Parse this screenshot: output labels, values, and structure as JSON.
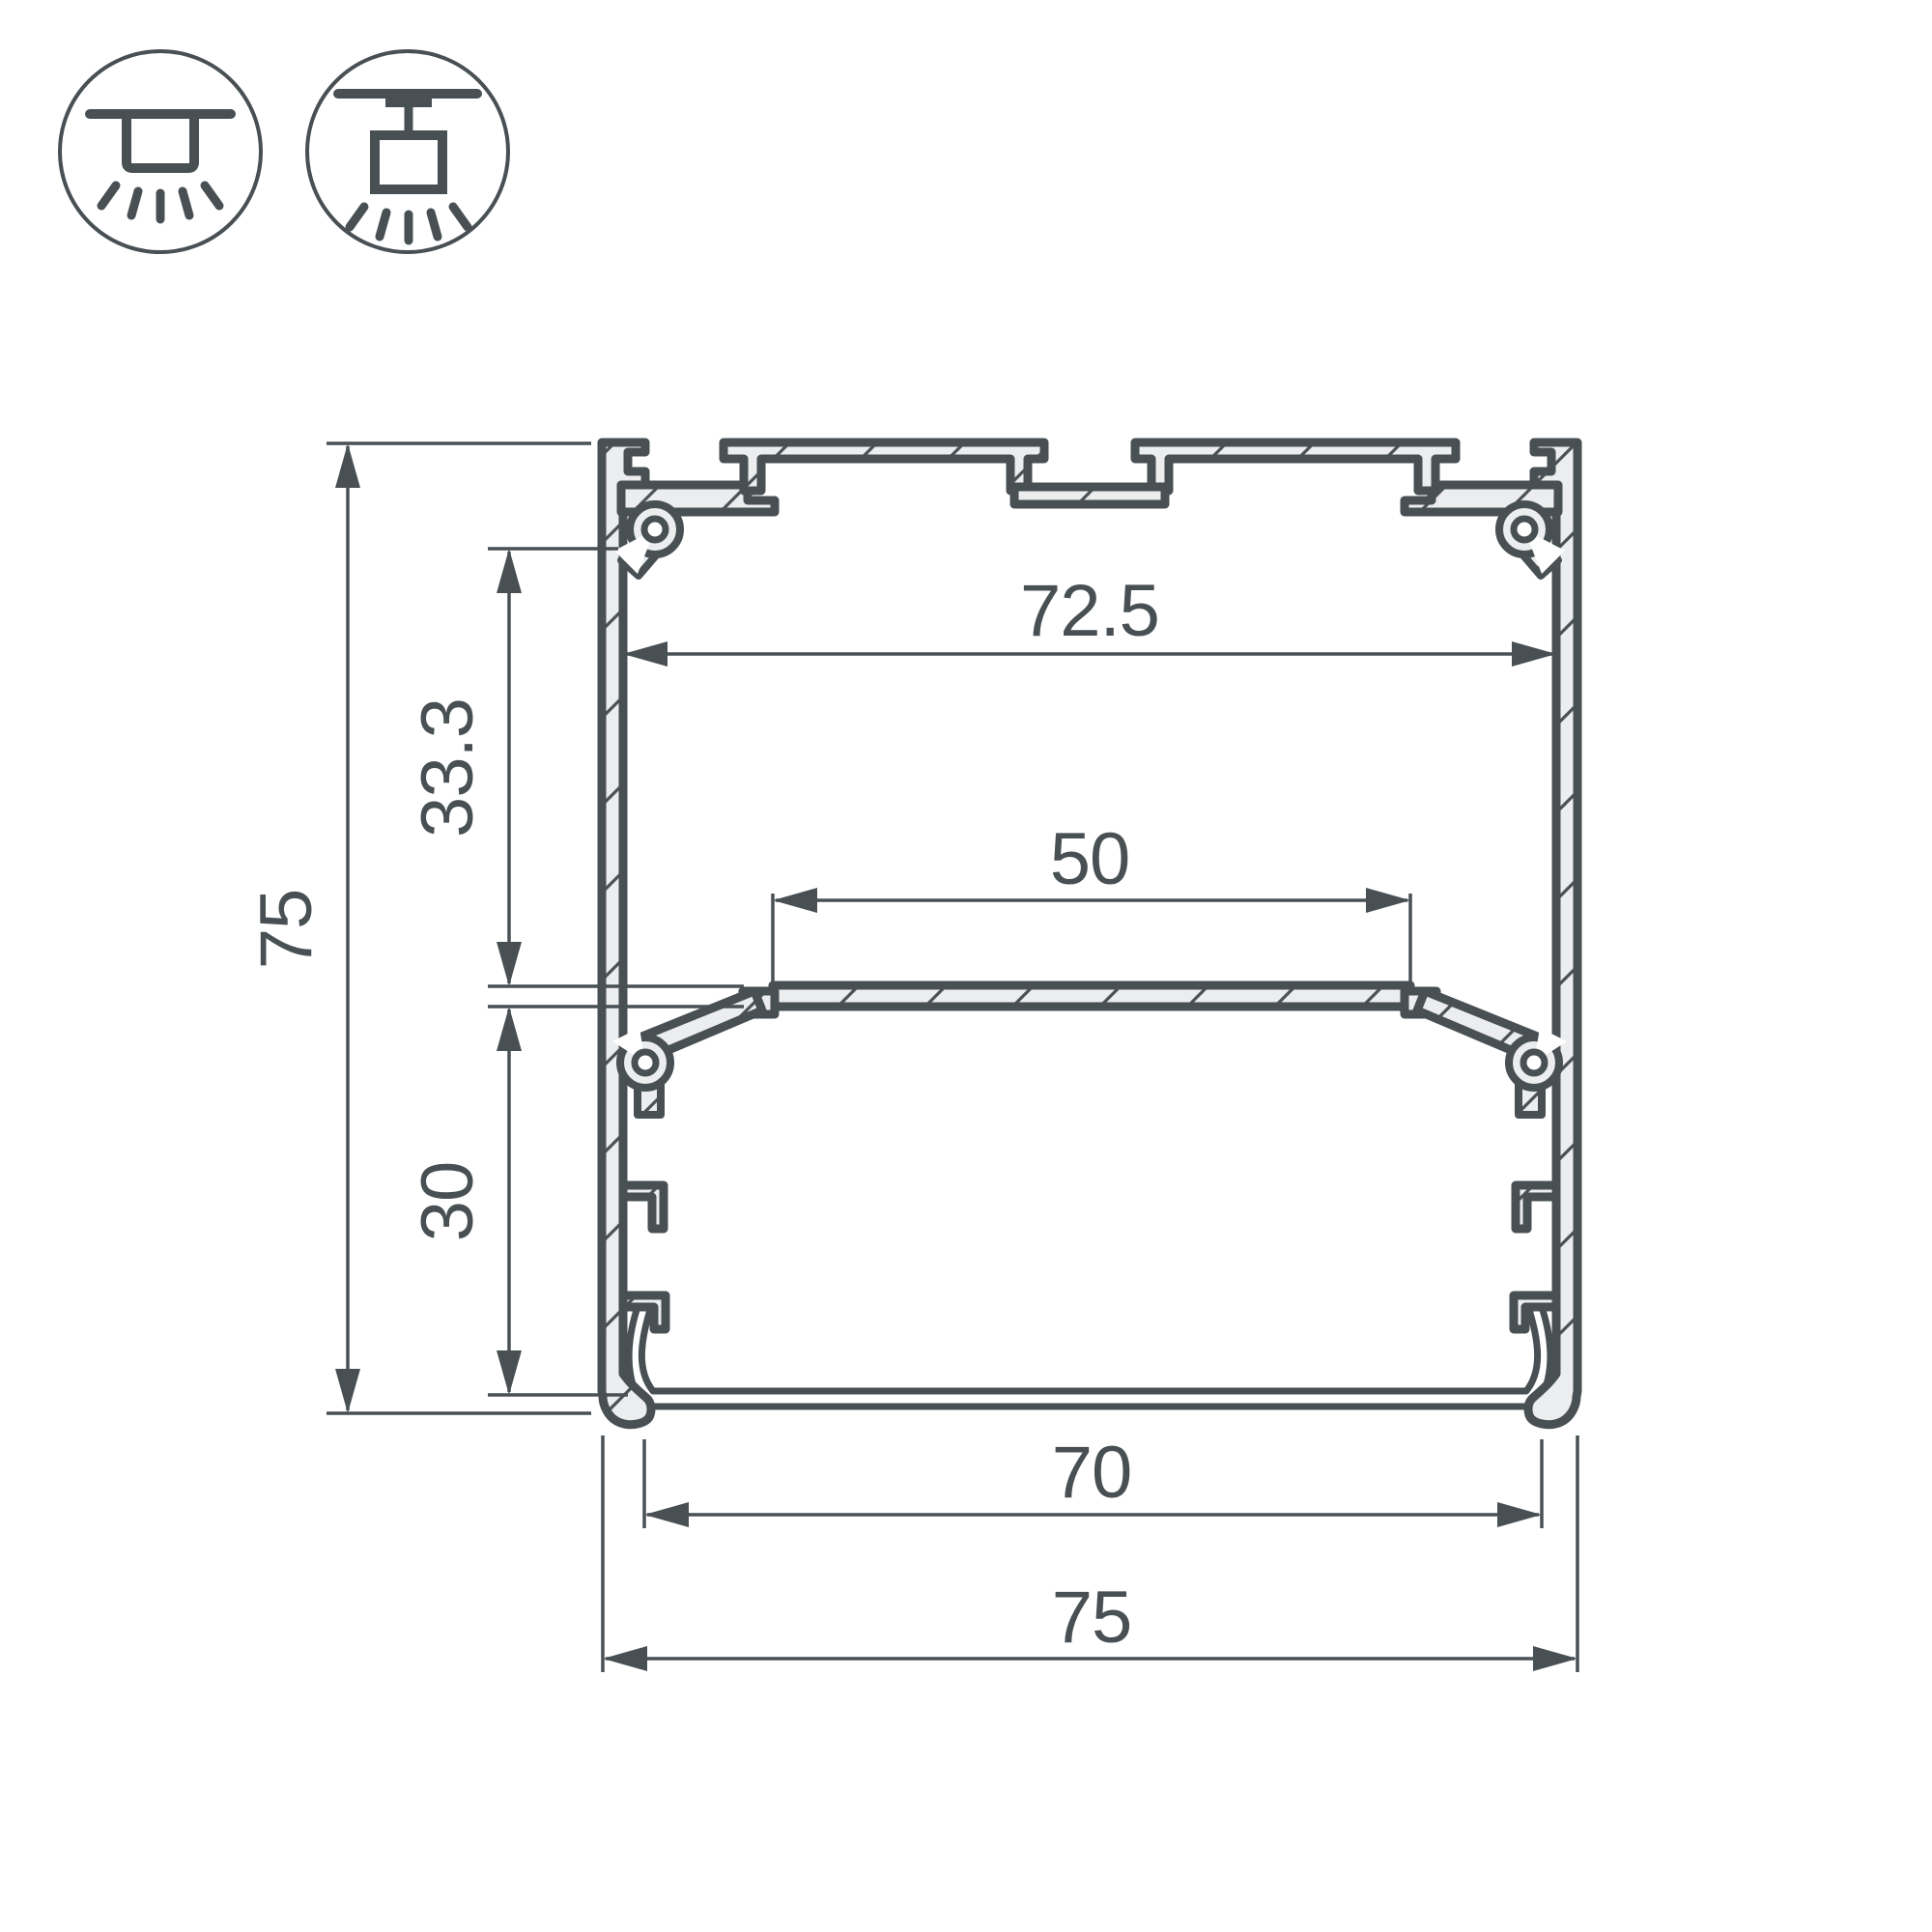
{
  "drawing": {
    "type": "led-profile-cross-section",
    "dimensions": {
      "overall_height": "75",
      "upper_chamber_height": "33.3",
      "lower_chamber_height": "30",
      "top_inner_width": "72.5",
      "led_platform_width": "50",
      "bottom_opening_width": "70",
      "overall_width": "75"
    },
    "icons": [
      {
        "name": "surface-mount-light-icon"
      },
      {
        "name": "suspended-mount-light-icon"
      }
    ],
    "colors": {
      "line": "#485054",
      "metal_fill": "#ecedee",
      "hatch": "#4a5156",
      "background": "#ffffff"
    }
  }
}
